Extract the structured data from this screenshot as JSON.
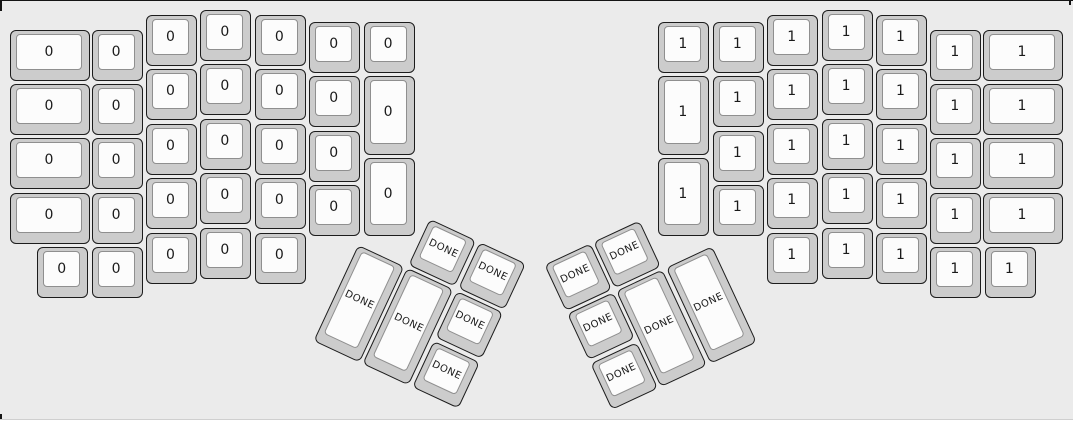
{
  "page": {
    "panel_background": "#ebebeb",
    "footer_background": "#ffffff",
    "divider_color": "#cfcfcf",
    "frame_border_color": "#141414"
  },
  "keycap_style": {
    "body_fill": "#cccccc",
    "body_border": "#1c1c1c",
    "top_fill": "#fcfcfc",
    "top_border": "#8f8f8f",
    "label_color": "#1a1a1a"
  },
  "keyboard": {
    "type": "ergodox-split-layout",
    "left_layer_label": "0",
    "right_layer_label": "1",
    "thumb_key_label": "DONE",
    "key_format": [
      "x",
      "y",
      "w",
      "h",
      "label"
    ],
    "left_keys": [
      [
        10,
        29.5,
        80,
        51,
        "0"
      ],
      [
        10,
        83.9,
        80,
        51,
        "0"
      ],
      [
        10,
        138.3,
        80,
        51,
        "0"
      ],
      [
        10,
        192.7,
        80,
        51,
        "0"
      ],
      [
        37.2,
        247.1,
        51,
        51,
        "0"
      ],
      [
        91.6,
        29.5,
        51,
        51,
        "0"
      ],
      [
        91.6,
        83.9,
        51,
        51,
        "0"
      ],
      [
        91.6,
        138.3,
        51,
        51,
        "0"
      ],
      [
        91.6,
        192.7,
        51,
        51,
        "0"
      ],
      [
        91.6,
        247.1,
        51,
        51,
        "0"
      ],
      [
        146,
        15,
        51,
        51,
        "0"
      ],
      [
        146,
        69.4,
        51,
        51,
        "0"
      ],
      [
        146,
        123.8,
        51,
        51,
        "0"
      ],
      [
        146,
        178.2,
        51,
        51,
        "0"
      ],
      [
        146,
        232.6,
        51,
        51,
        "0"
      ],
      [
        200.4,
        10,
        51,
        51,
        "0"
      ],
      [
        200.4,
        64.4,
        51,
        51,
        "0"
      ],
      [
        200.4,
        118.8,
        51,
        51,
        "0"
      ],
      [
        200.4,
        173.2,
        51,
        51,
        "0"
      ],
      [
        200.4,
        227.6,
        51,
        51,
        "0"
      ],
      [
        254.8,
        15,
        51,
        51,
        "0"
      ],
      [
        254.8,
        69.4,
        51,
        51,
        "0"
      ],
      [
        254.8,
        123.8,
        51,
        51,
        "0"
      ],
      [
        254.8,
        178.2,
        51,
        51,
        "0"
      ],
      [
        254.8,
        232.6,
        51,
        51,
        "0"
      ],
      [
        309.2,
        22,
        51,
        51,
        "0"
      ],
      [
        309.2,
        76.4,
        51,
        51,
        "0"
      ],
      [
        309.2,
        130.8,
        51,
        51,
        "0"
      ],
      [
        309.2,
        185.2,
        51,
        51,
        "0"
      ],
      [
        363.6,
        22,
        51,
        51,
        "0"
      ],
      [
        363.6,
        76.4,
        51,
        78.2,
        "0"
      ],
      [
        363.6,
        158,
        51,
        78.2,
        "0"
      ]
    ],
    "right_keys": [
      [
        658.4,
        22,
        51,
        51,
        "1"
      ],
      [
        658.4,
        76.4,
        51,
        78.2,
        "1"
      ],
      [
        658.4,
        158,
        51,
        78.2,
        "1"
      ],
      [
        712.8,
        22,
        51,
        51,
        "1"
      ],
      [
        712.8,
        76.4,
        51,
        51,
        "1"
      ],
      [
        712.8,
        130.8,
        51,
        51,
        "1"
      ],
      [
        712.8,
        185.2,
        51,
        51,
        "1"
      ],
      [
        767.2,
        15,
        51,
        51,
        "1"
      ],
      [
        767.2,
        69.4,
        51,
        51,
        "1"
      ],
      [
        767.2,
        123.8,
        51,
        51,
        "1"
      ],
      [
        767.2,
        178.2,
        51,
        51,
        "1"
      ],
      [
        767.2,
        232.6,
        51,
        51,
        "1"
      ],
      [
        821.6,
        10,
        51,
        51,
        "1"
      ],
      [
        821.6,
        64.4,
        51,
        51,
        "1"
      ],
      [
        821.6,
        118.8,
        51,
        51,
        "1"
      ],
      [
        821.6,
        173.2,
        51,
        51,
        "1"
      ],
      [
        821.6,
        227.6,
        51,
        51,
        "1"
      ],
      [
        876,
        15,
        51,
        51,
        "1"
      ],
      [
        876,
        69.4,
        51,
        51,
        "1"
      ],
      [
        876,
        123.8,
        51,
        51,
        "1"
      ],
      [
        876,
        178.2,
        51,
        51,
        "1"
      ],
      [
        876,
        232.6,
        51,
        51,
        "1"
      ],
      [
        930.4,
        29.5,
        51,
        51,
        "1"
      ],
      [
        930.4,
        83.9,
        51,
        51,
        "1"
      ],
      [
        930.4,
        138.3,
        51,
        51,
        "1"
      ],
      [
        930.4,
        192.7,
        51,
        51,
        "1"
      ],
      [
        930.4,
        247.1,
        51,
        51,
        "1"
      ],
      [
        983,
        29.5,
        80,
        51,
        "1"
      ],
      [
        983,
        83.9,
        80,
        51,
        "1"
      ],
      [
        983,
        138.3,
        80,
        51,
        "1"
      ],
      [
        983,
        192.7,
        80,
        51,
        "1"
      ],
      [
        984.8,
        247.1,
        51,
        51,
        "1"
      ]
    ],
    "left_thumb": {
      "origin_x": 381,
      "origin_y": 196,
      "angle_deg": 25,
      "keys": [
        [
          54.4,
          0,
          51,
          51,
          "DONE"
        ],
        [
          108.8,
          0,
          51,
          51,
          "DONE"
        ],
        [
          0,
          54.4,
          51,
          105.4,
          "DONE"
        ],
        [
          54.4,
          54.4,
          51,
          105.4,
          "DONE"
        ],
        [
          108.8,
          54.4,
          51,
          51,
          "DONE"
        ],
        [
          108.8,
          108.8,
          51,
          51,
          "DONE"
        ]
      ]
    },
    "right_thumb": {
      "origin_x": 692,
      "origin_y": 196,
      "angle_deg": -25,
      "keys": [
        [
          -108.8,
          0,
          51,
          51,
          "DONE"
        ],
        [
          -163.2,
          0,
          51,
          51,
          "DONE"
        ],
        [
          -54.4,
          54.4,
          51,
          105.4,
          "DONE"
        ],
        [
          -108.8,
          54.4,
          51,
          105.4,
          "DONE"
        ],
        [
          -163.2,
          54.4,
          51,
          51,
          "DONE"
        ],
        [
          -163.2,
          108.8,
          51,
          51,
          "DONE"
        ]
      ]
    }
  }
}
